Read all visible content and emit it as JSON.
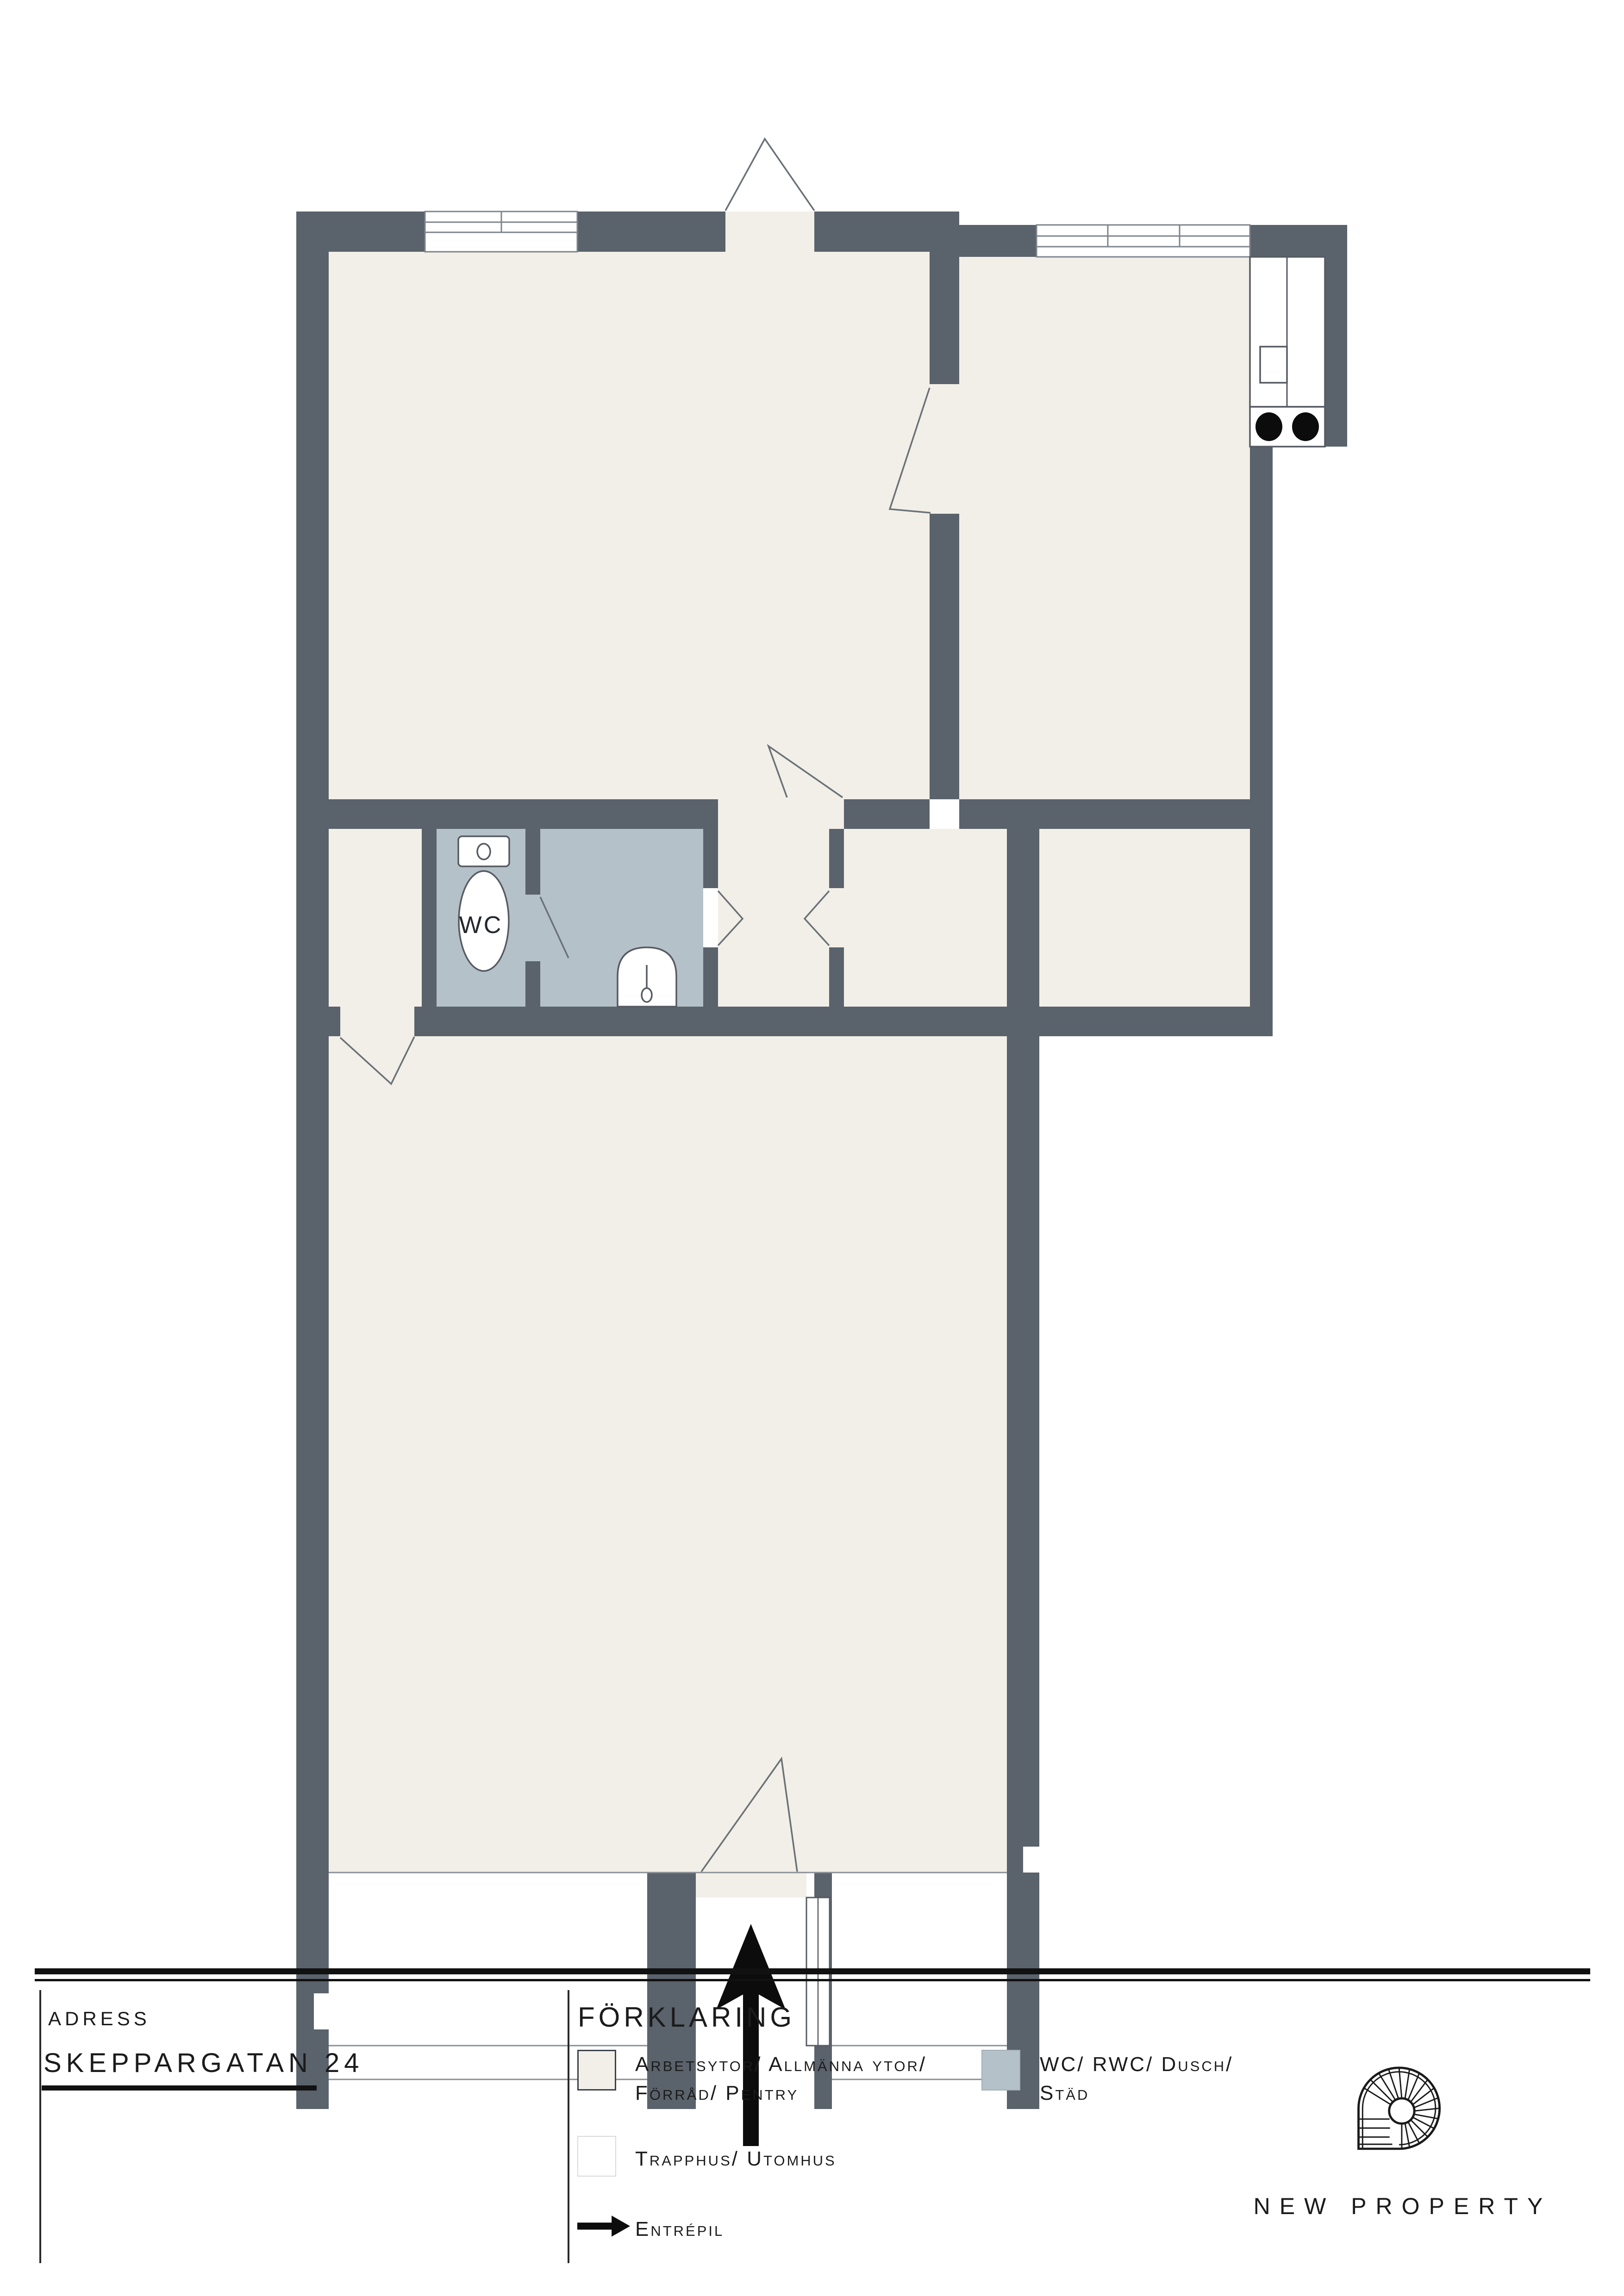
{
  "plan": {
    "wc_label": "WC",
    "features": {
      "rooms": [
        "work-area-top-left",
        "kitchen-top-right",
        "wc-shower-room",
        "vestibule",
        "hallway",
        "work-area-lower"
      ],
      "fixtures": [
        "toilet",
        "wash-basin",
        "kitchen-counter",
        "kitchen-sink",
        "stove-two-burners"
      ],
      "entrances": [
        "top-door",
        "main-entrance-bottom-with-arrow"
      ]
    },
    "colors": {
      "wall": "#5a626b",
      "work_floor": "#f2efe8",
      "wet_floor": "#b5c1c8",
      "outside": "#ffffff",
      "thin_line": "#6a7177"
    }
  },
  "footer": {
    "address_label": "ADRESS",
    "address_value": "SKEPPARGATAN 24",
    "legend_title": "FÖRKLARING",
    "legend": [
      {
        "swatch_color": "#f2efe8",
        "line1": "Arbetsytor/ Allmänna ytor/",
        "line2": "Förråd/ Pentry"
      },
      {
        "swatch_color": "#b5c1c8",
        "line1": "WC/ RWC/ Dusch/",
        "line2": "Städ"
      },
      {
        "swatch_color": "#ffffff",
        "line1": "Trapphus/ Utomhus",
        "line2": ""
      },
      {
        "icon": "entrance-arrow-icon",
        "line1": "Entrépil",
        "line2": ""
      }
    ]
  },
  "brand": {
    "name": "NEW PROPERTY",
    "logo": "spiral-staircase-icon"
  }
}
